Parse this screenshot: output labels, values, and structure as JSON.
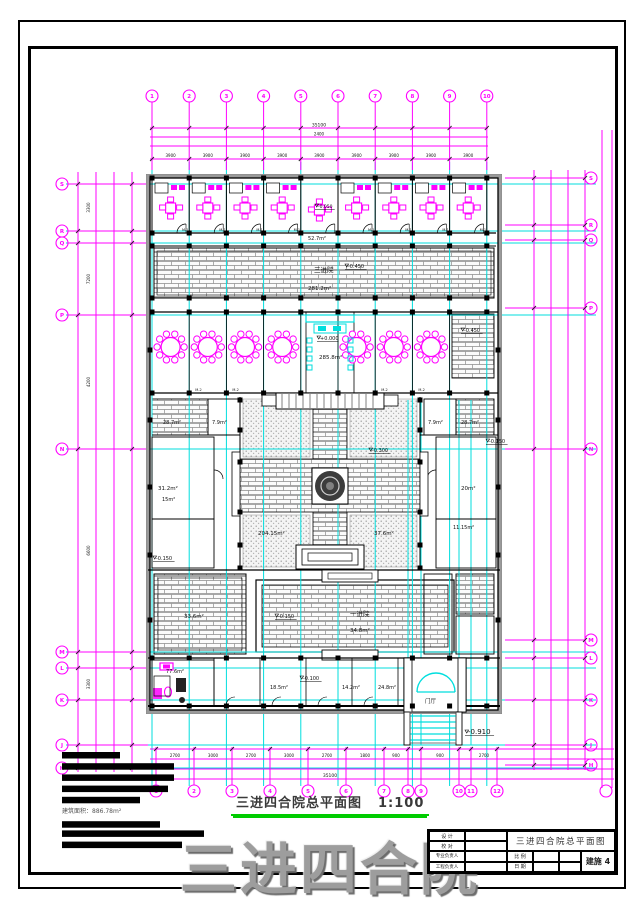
{
  "sheet": {
    "drawing_title": "三进四合院总平面图",
    "drawing_scale": "1:100",
    "watermark": "三进四合院",
    "notes_caption": "建筑面积：886.78m²"
  },
  "titleblock": {
    "rows": [
      "设 计",
      "校 对",
      "专业负责人",
      "工程负责人"
    ],
    "project_title": "三进四合院总平面图",
    "scale_label": "比 例",
    "date_label": "日 期",
    "sheet_label": "建施 4"
  },
  "axes": {
    "top": [
      "1",
      "2",
      "3",
      "4",
      "5",
      "6",
      "7",
      "8",
      "9",
      "10"
    ],
    "bottom": [
      "1",
      "2",
      "3",
      "4",
      "5",
      "6",
      "7",
      "8",
      "9",
      "10",
      "11",
      "12"
    ],
    "left": [
      "S",
      "R",
      "Q",
      "P",
      "N",
      "M",
      "L",
      "K",
      "J",
      "H"
    ],
    "right": [
      "S",
      "R",
      "Q",
      "P",
      "N",
      "M",
      "L",
      "K",
      "J",
      "H"
    ]
  },
  "dims": {
    "top_total": "35100",
    "top_sub": "2400",
    "top_segments": [
      "3900",
      "3900",
      "3900",
      "3900",
      "3900",
      "3900",
      "3900",
      "3900",
      "3900"
    ],
    "bottom_total": "35100",
    "bottom_segments": [
      "2700",
      "3000",
      "2700",
      "3000",
      "2700",
      "1800",
      "900",
      "2700",
      "900",
      "2100",
      "2700"
    ],
    "left_segments": [
      "3300",
      "7200",
      "4200",
      "6600",
      "3300"
    ],
    "right_segments": [
      "3300",
      "7200",
      "4200",
      "6600",
      "3300"
    ]
  },
  "rooms": {
    "guest_door_tag": "M-1",
    "hall_door_tag": "M-2"
  },
  "notes_bar_widths": [
    58,
    112,
    112,
    106,
    78,
    98,
    142,
    120
  ],
  "annotations": [
    {
      "text": "-0.050",
      "x": 318,
      "y": 208,
      "fs": 4.5
    },
    {
      "text": "52.7m²",
      "x": 308,
      "y": 240,
      "fs": 5
    },
    {
      "text": "三进院",
      "x": 314,
      "y": 272,
      "fs": 6.5
    },
    {
      "text": "281.2m²",
      "x": 308,
      "y": 290,
      "fs": 5.5
    },
    {
      "text": "-0.450",
      "x": 348,
      "y": 268,
      "fs": 5
    },
    {
      "text": "+0.000",
      "x": 320,
      "y": 340,
      "fs": 5
    },
    {
      "text": "285.8m²",
      "x": 319,
      "y": 359,
      "fs": 5.5
    },
    {
      "text": "-0.450",
      "x": 464,
      "y": 332,
      "fs": 5
    },
    {
      "text": "-0.300",
      "x": 372,
      "y": 452,
      "fs": 5
    },
    {
      "text": "204.15m²",
      "x": 258,
      "y": 535,
      "fs": 5.5
    },
    {
      "text": "37.6m²",
      "x": 374,
      "y": 535,
      "fs": 5.5
    },
    {
      "text": "28.7m²",
      "x": 163,
      "y": 424,
      "fs": 5
    },
    {
      "text": "7.9m²",
      "x": 212,
      "y": 424,
      "fs": 5
    },
    {
      "text": "31.2m²",
      "x": 158,
      "y": 490,
      "fs": 5.5
    },
    {
      "text": "15m²",
      "x": 162,
      "y": 501,
      "fs": 5
    },
    {
      "text": "-0.150",
      "x": 156,
      "y": 560,
      "fs": 5
    },
    {
      "text": "7.9m²",
      "x": 428,
      "y": 424,
      "fs": 5
    },
    {
      "text": "28.7m²",
      "x": 461,
      "y": 424,
      "fs": 5
    },
    {
      "text": "20m²",
      "x": 461,
      "y": 490,
      "fs": 5.5
    },
    {
      "text": "11.15m²",
      "x": 453,
      "y": 529,
      "fs": 5
    },
    {
      "text": "-0.150",
      "x": 489,
      "y": 443,
      "fs": 5
    },
    {
      "text": "33.6m²",
      "x": 184,
      "y": 618,
      "fs": 5.5
    },
    {
      "text": "-0.150",
      "x": 278,
      "y": 618,
      "fs": 5
    },
    {
      "text": "一进院",
      "x": 350,
      "y": 616,
      "fs": 6.5
    },
    {
      "text": "34.8m²",
      "x": 350,
      "y": 632,
      "fs": 5.5
    },
    {
      "text": "-0.100",
      "x": 303,
      "y": 680,
      "fs": 5
    },
    {
      "text": "77.6m²",
      "x": 166,
      "y": 673,
      "fs": 5
    },
    {
      "text": "18.5m²",
      "x": 270,
      "y": 689,
      "fs": 5
    },
    {
      "text": "14.2m²",
      "x": 342,
      "y": 689,
      "fs": 5
    },
    {
      "text": "24.8m²",
      "x": 378,
      "y": 689,
      "fs": 5
    },
    {
      "text": "门厅",
      "x": 425,
      "y": 703,
      "fs": 5.5
    },
    {
      "text": "-0.910",
      "x": 468,
      "y": 734,
      "fs": 7
    }
  ]
}
